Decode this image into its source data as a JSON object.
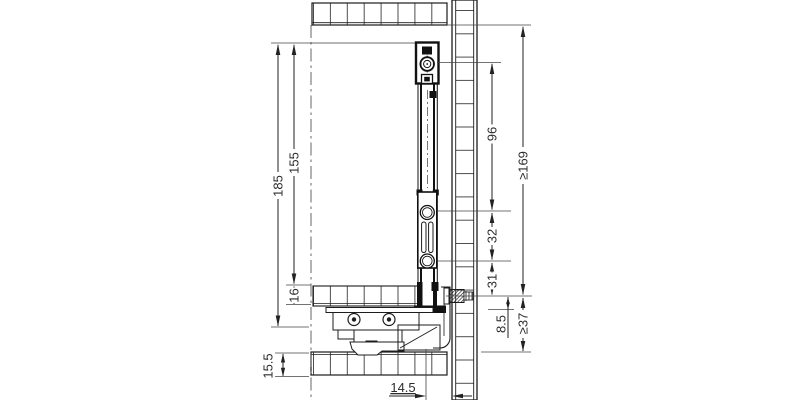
{
  "drawing": {
    "type": "technical-cross-section",
    "subject": "drawer side profile and runner mounted to rear panel",
    "line_color": "#1c1c1c",
    "dims": {
      "side_profile_height": "185",
      "inner_height": "155",
      "drawer_bottom_thickness": "16",
      "bottom_rail_height": "15.5",
      "fixing_hole_top": "96",
      "fixing_hole_mid": "32",
      "fixing_hole_bottom": "31",
      "screw_offset": "8.5",
      "min_rear_panel_height": "≥169",
      "min_bottom_clearance": "≥37",
      "rear_gap": "14.5"
    }
  }
}
